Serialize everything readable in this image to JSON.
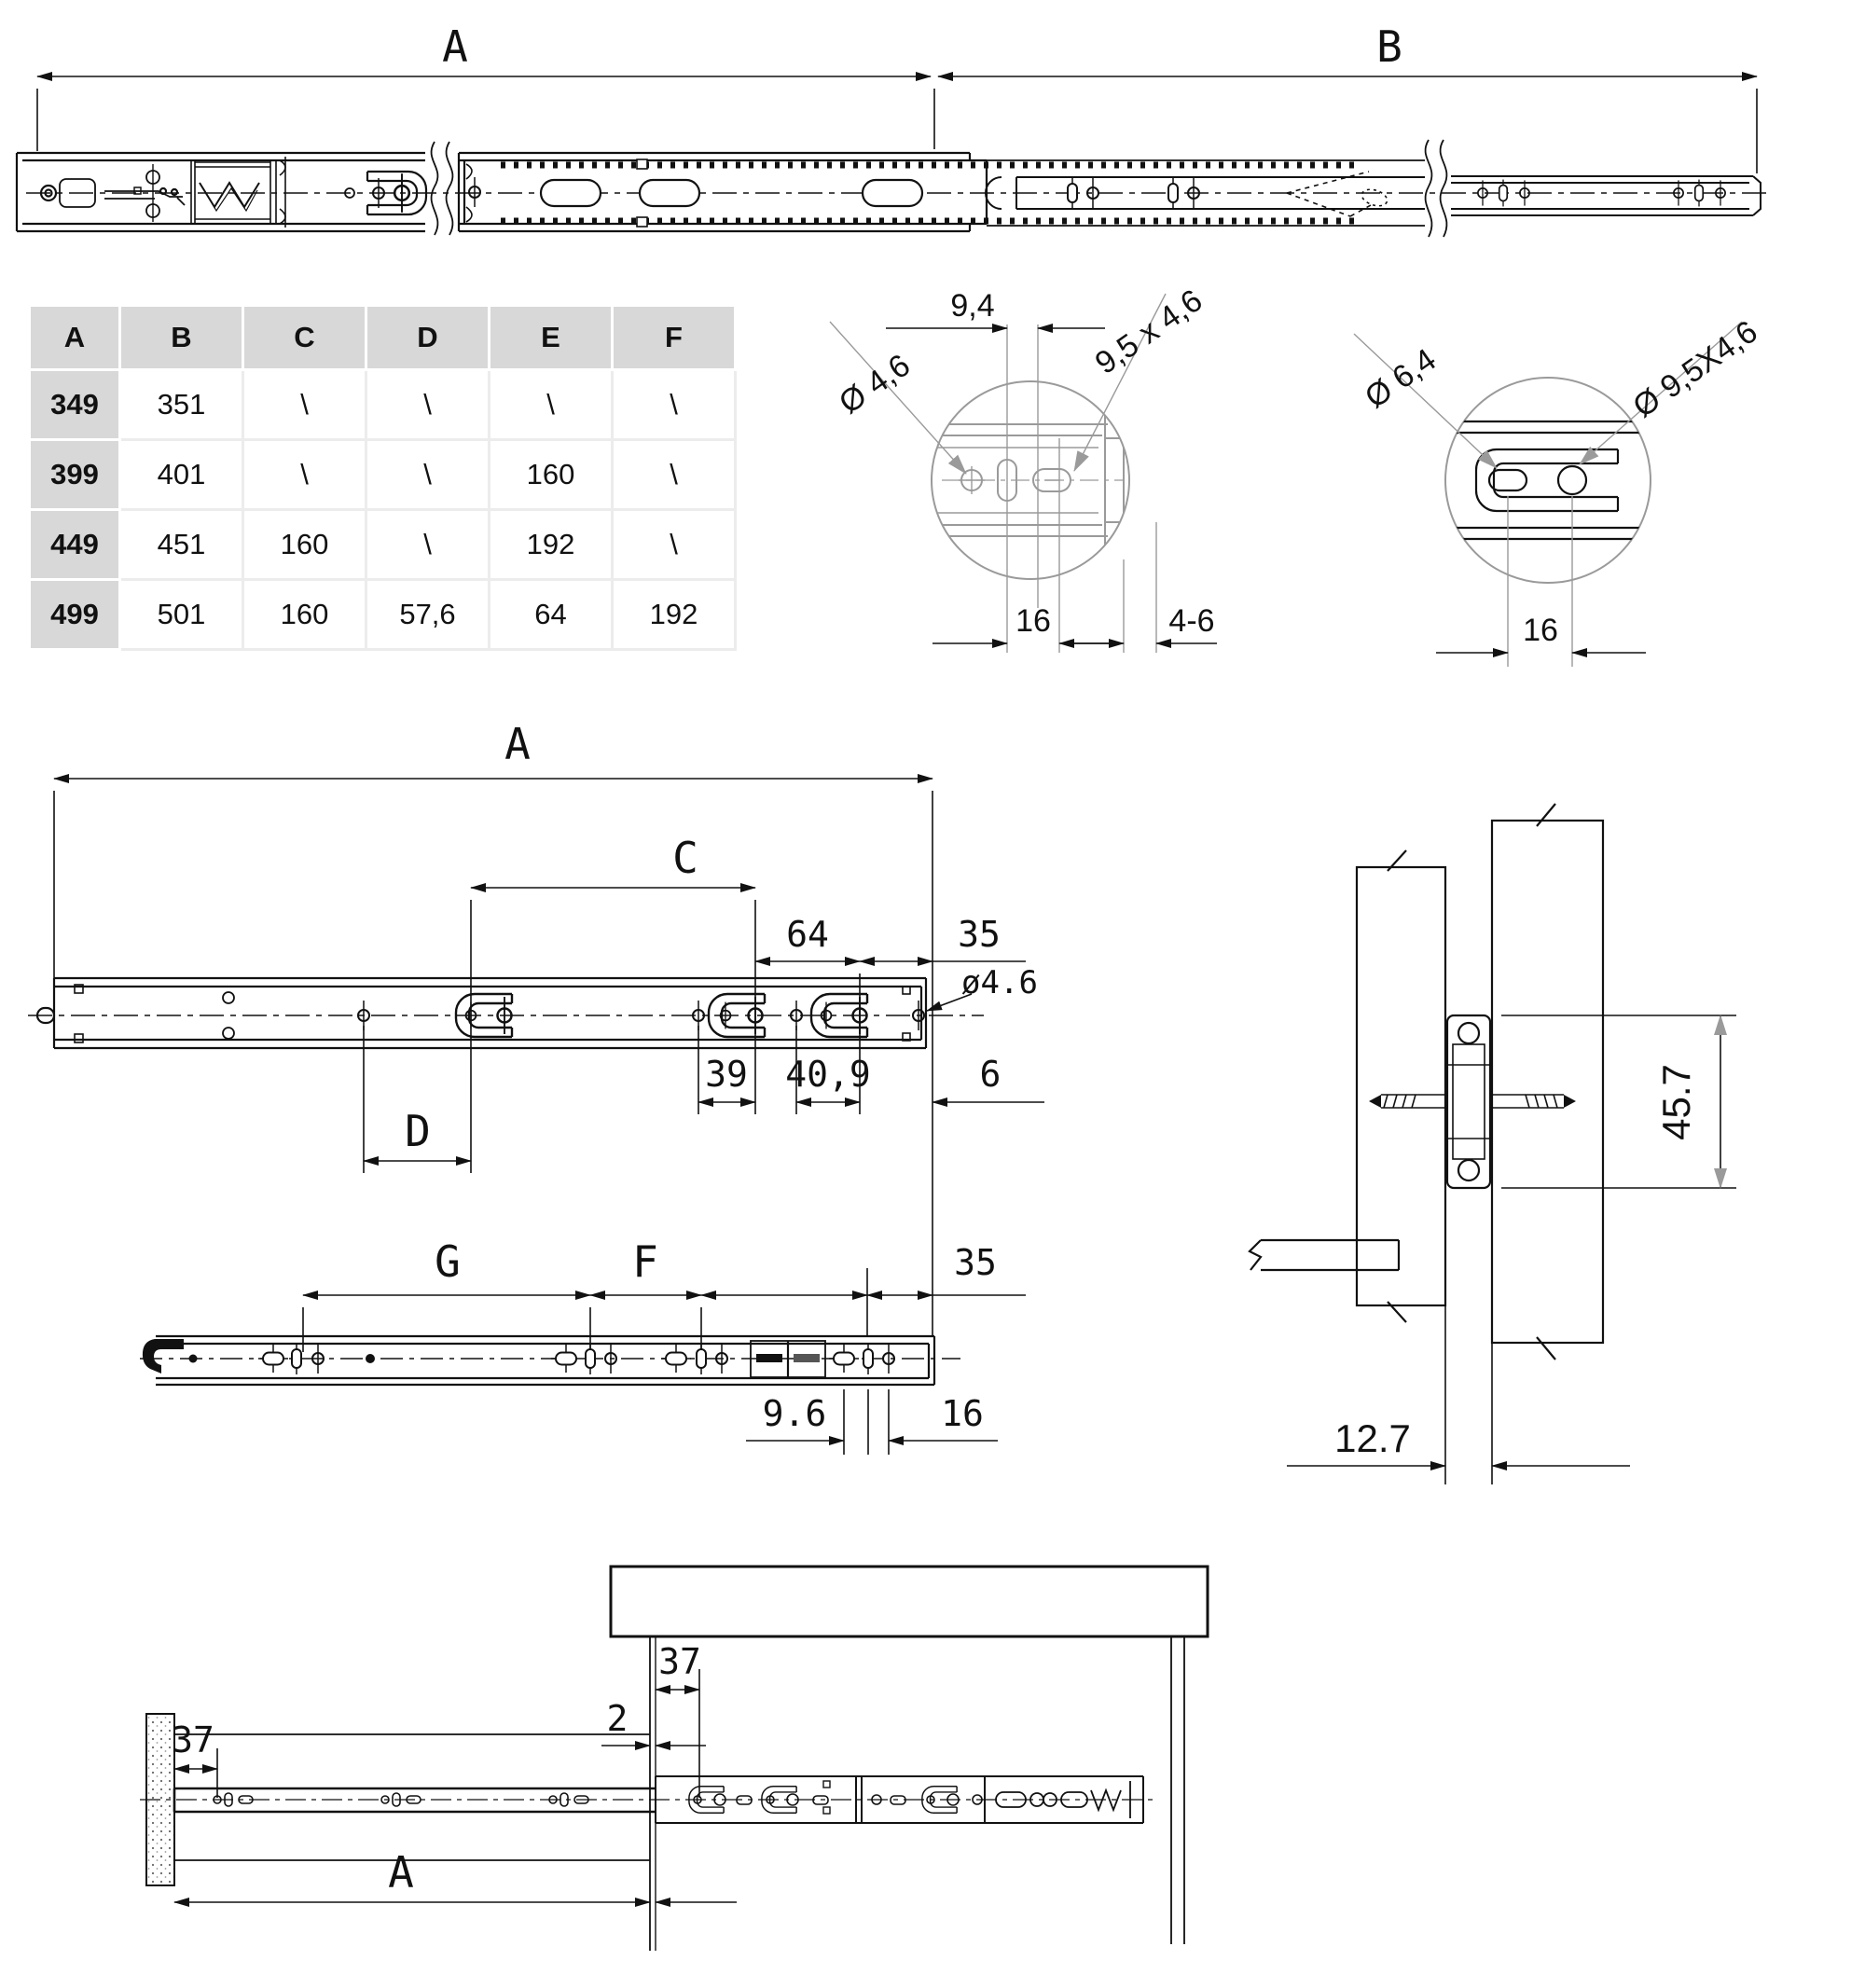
{
  "colors": {
    "line": "#111111",
    "detail_line": "#9a9a9a",
    "table_header_bg": "#d8d8d8"
  },
  "top_view": {
    "dim_a": "A",
    "dim_b": "B"
  },
  "size_table": {
    "headers": [
      "A",
      "B",
      "C",
      "D",
      "E",
      "F"
    ],
    "rows": [
      [
        "349",
        "351",
        "\\",
        "\\",
        "\\",
        "\\"
      ],
      [
        "399",
        "401",
        "\\",
        "\\",
        "160",
        "\\"
      ],
      [
        "449",
        "451",
        "160",
        "\\",
        "192",
        "\\"
      ],
      [
        "499",
        "501",
        "160",
        "57,6",
        "64",
        "192"
      ]
    ]
  },
  "front_detail": {
    "offset": "9,4",
    "hole": "Ø 4,6",
    "slot": "9,5 x 4,6",
    "pitch": "16",
    "thickness": "4-6"
  },
  "rear_detail": {
    "slot": "Ø 6,4",
    "hole": "Ø 9,5X4,6",
    "pitch": "16"
  },
  "outer_member": {
    "dim_a": "A",
    "dim_c": "C",
    "dim_64": "64",
    "dim_35": "35",
    "hole": "ø4.6",
    "dim_d": "D",
    "dim_39": "39",
    "dim_40_9": "40,9",
    "dim_6": "6"
  },
  "cross_section": {
    "height": "45.7",
    "offset": "12.7"
  },
  "inner_member": {
    "dim_g": "G",
    "dim_f": "F",
    "dim_35": "35",
    "dim_9_6": "9.6",
    "dim_16": "16"
  },
  "installation": {
    "front_offset": "37",
    "gap": "2",
    "rear_offset": "37",
    "dim_a": "A"
  }
}
